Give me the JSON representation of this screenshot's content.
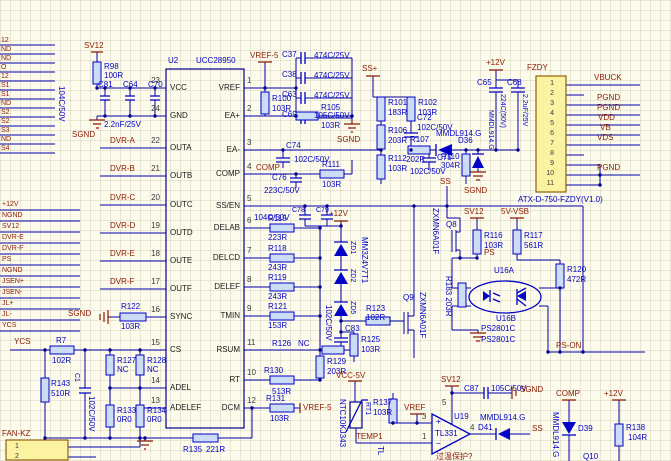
{
  "nets": {
    "sv12": "SV12",
    "sgnd": "SGND",
    "vref5": "VREF-5",
    "ssp": "SS+",
    "p12": "+12V",
    "ss": "SS",
    "vsb": "5V-VSB",
    "ps": "PS",
    "pson": "PS-ON",
    "vcc5": "VCC-5V",
    "vref": "VREF",
    "comp": "COMP",
    "ycs": "YCS",
    "temp1": "TEMP1",
    "vbuck": "VBUCK",
    "pgnd": "PGND",
    "vdd": "VDD",
    "vb": "VB",
    "vds": "VDS",
    "fankz": "FAN-KZ",
    "fzdy": "FZDY",
    "note": "过温保护?",
    "tl": "TL"
  },
  "bus_top": [
    "12",
    "ND",
    "ND",
    "O",
    "12",
    "S1",
    "S1",
    "ND",
    "S2",
    "S2",
    "S3",
    "ND",
    "S4"
  ],
  "bus_mid": [
    "+12V",
    "NGND",
    "SV12",
    "DVR-E",
    "DVR-F",
    "PS",
    "NGND",
    "JSEN+",
    "JSEN-",
    "JL+",
    "JL-",
    "YCS"
  ],
  "u2": {
    "ref": "U2",
    "part": "UCC28950",
    "left": [
      {
        "n": "23",
        "name": "VCC"
      },
      {
        "n": "24",
        "name": "GND"
      },
      {
        "n": "22",
        "name": "OUTA",
        "net": "DVR-A"
      },
      {
        "n": "21",
        "name": "OUTB",
        "net": "DVR-B"
      },
      {
        "n": "20",
        "name": "OUTC",
        "net": "DVR-C"
      },
      {
        "n": "19",
        "name": "OUTD",
        "net": "DVR-D"
      },
      {
        "n": "18",
        "name": "OUTE",
        "net": "DVR-E"
      },
      {
        "n": "17",
        "name": "OUTF",
        "net": "DVR-F"
      },
      {
        "n": "16",
        "name": "SYNC"
      },
      {
        "n": "15",
        "name": "CS"
      },
      {
        "n": "14",
        "name": "ADEL"
      },
      {
        "n": "13",
        "name": "ADELEF"
      }
    ],
    "right": [
      {
        "n": "1",
        "name": "VREF"
      },
      {
        "n": "2",
        "name": "EA+"
      },
      {
        "n": "3",
        "name": "EA-"
      },
      {
        "n": "4",
        "name": "COMP"
      },
      {
        "n": "5",
        "name": "SS/EN"
      },
      {
        "n": "6",
        "name": "DELAB"
      },
      {
        "n": "7",
        "name": "DELCD"
      },
      {
        "n": "8",
        "name": "DELEF"
      },
      {
        "n": "9",
        "name": "TMIN"
      },
      {
        "n": "11",
        "name": "RSUM"
      },
      {
        "n": "10",
        "name": "RT"
      },
      {
        "n": "12",
        "name": "DCM"
      }
    ]
  },
  "fzdy": {
    "part": "ATX-D-750-FZDY(V1.0)",
    "pins": [
      "1",
      "2",
      "3",
      "4",
      "5",
      "6",
      "7",
      "8",
      "9",
      "10",
      "11"
    ]
  },
  "fan": {
    "pins": [
      "1",
      "2"
    ]
  },
  "parts": {
    "r98": {
      "r": "R98",
      "v": "100R"
    },
    "clc": {
      "c81": "C81",
      "c64": "C64",
      "c70": "C70",
      "vv": "104C/50V",
      "val": "2.2nF/25V"
    },
    "r100": {
      "r": "R100",
      "v": "103R"
    },
    "c37": {
      "r": "C37",
      "v": "474C/25V"
    },
    "c38": {
      "r": "C38",
      "v": "474C/25V"
    },
    "c63": {
      "r": "C63",
      "v": "474C/25V"
    },
    "c69": {
      "r": "C69",
      "v": "105C/50V"
    },
    "r105": {
      "r": "R105",
      "v": "103R"
    },
    "c74": {
      "r": "C74",
      "v": "102C/50V"
    },
    "c76": {
      "r": "C76",
      "v": "223C/50V"
    },
    "r111": {
      "r": "R111",
      "v": "103R"
    },
    "r101": {
      "r": "R101",
      "v": "183R"
    },
    "r102": {
      "r": "R102",
      "v": "103R"
    },
    "c72": {
      "r": "C72",
      "v": "102C/50V"
    },
    "r106": {
      "r": "R106",
      "v": "203R"
    },
    "r107": {
      "r": "R107",
      "v": "202R"
    },
    "r112": {
      "r": "R112",
      "v": "103R"
    },
    "c75": {
      "r": "C75",
      "v": "102C/50V"
    },
    "d36": {
      "r": "D36",
      "p": "MMDL914.G"
    },
    "r110": {
      "r": "R110",
      "v": "304R"
    },
    "d37": {
      "p": "MMDL914.G"
    },
    "c65": {
      "r": "C65",
      "v": "224C(50V)"
    },
    "c68": {
      "r": "C68",
      "v": "2.2uF/25V"
    },
    "c78": {
      "r": "C78"
    },
    "c79": {
      "r": "C79",
      "v": "104C/50V"
    },
    "zd1": {
      "r": "ZD1"
    },
    "zd2": {
      "r": "ZD2"
    },
    "zd5": {
      "r": "ZD5"
    },
    "zdp": "MM3Z4V7T1",
    "c83": {
      "r": "C83",
      "v": "102C/50V"
    },
    "r123": {
      "r": "R123",
      "v": "102R"
    },
    "r125": {
      "r": "R125",
      "v": "103R"
    },
    "q9": {
      "r": "Q9",
      "p": "ZXMN6A01F"
    },
    "r115": {
      "r": "R115",
      "v": "223R"
    },
    "r118": {
      "r": "R118",
      "v": "243R"
    },
    "r119": {
      "r": "R119",
      "v": "243R"
    },
    "r121": {
      "r": "R121",
      "v": "153R"
    },
    "r126": {
      "r": "R126",
      "v": "NC"
    },
    "r129": {
      "r": "R129",
      "v": "203R"
    },
    "r130": {
      "r": "R130",
      "v": "513R"
    },
    "r131": {
      "r": "R131",
      "v": "103R"
    },
    "r122": {
      "r": "R122",
      "v": "103R"
    },
    "r7": {
      "r": "R7",
      "v": "102R"
    },
    "r143": {
      "r": "R143",
      "v": "510R"
    },
    "c1": {
      "r": "C1",
      "v": "102C/50V"
    },
    "r127": {
      "r": "R127",
      "v": "NC"
    },
    "r128": {
      "r": "R128",
      "v": "NC"
    },
    "r133": {
      "r": "R133",
      "v": "0R0"
    },
    "r134": {
      "r": "R134",
      "v": "0R0"
    },
    "r135": {
      "r": "R135",
      "v": "221R"
    },
    "q8": {
      "r": "Q8",
      "p": "ZXMN6A01F"
    },
    "r116": {
      "r": "R116",
      "v": "103R"
    },
    "r117": {
      "r": "R117",
      "v": "561R"
    },
    "r183": "R183 203R",
    "r120": {
      "r": "R120",
      "v": "472R"
    },
    "u16": {
      "a": "U16A",
      "b": "U16B",
      "p": "PS2801C",
      "p2": "PS2801C"
    },
    "u19": {
      "r": "U19",
      "p": "TL331",
      "plus": "+",
      "minus": "−",
      "n3": "3",
      "n1": "1",
      "n5": "5",
      "n4": "4"
    },
    "d41": {
      "r": "D41",
      "p": "MMDL914.G"
    },
    "c87": {
      "r": "C87",
      "v": "105C/50V"
    },
    "rt1": {
      "r": "RT1",
      "p": "NTC10KJ343"
    },
    "r137": {
      "r": "R137",
      "v": "103R"
    },
    "d39": {
      "r": "D39",
      "p": "MMDL914.G"
    },
    "r138": {
      "r": "R138",
      "v": "104R"
    },
    "q10": "Q10"
  }
}
